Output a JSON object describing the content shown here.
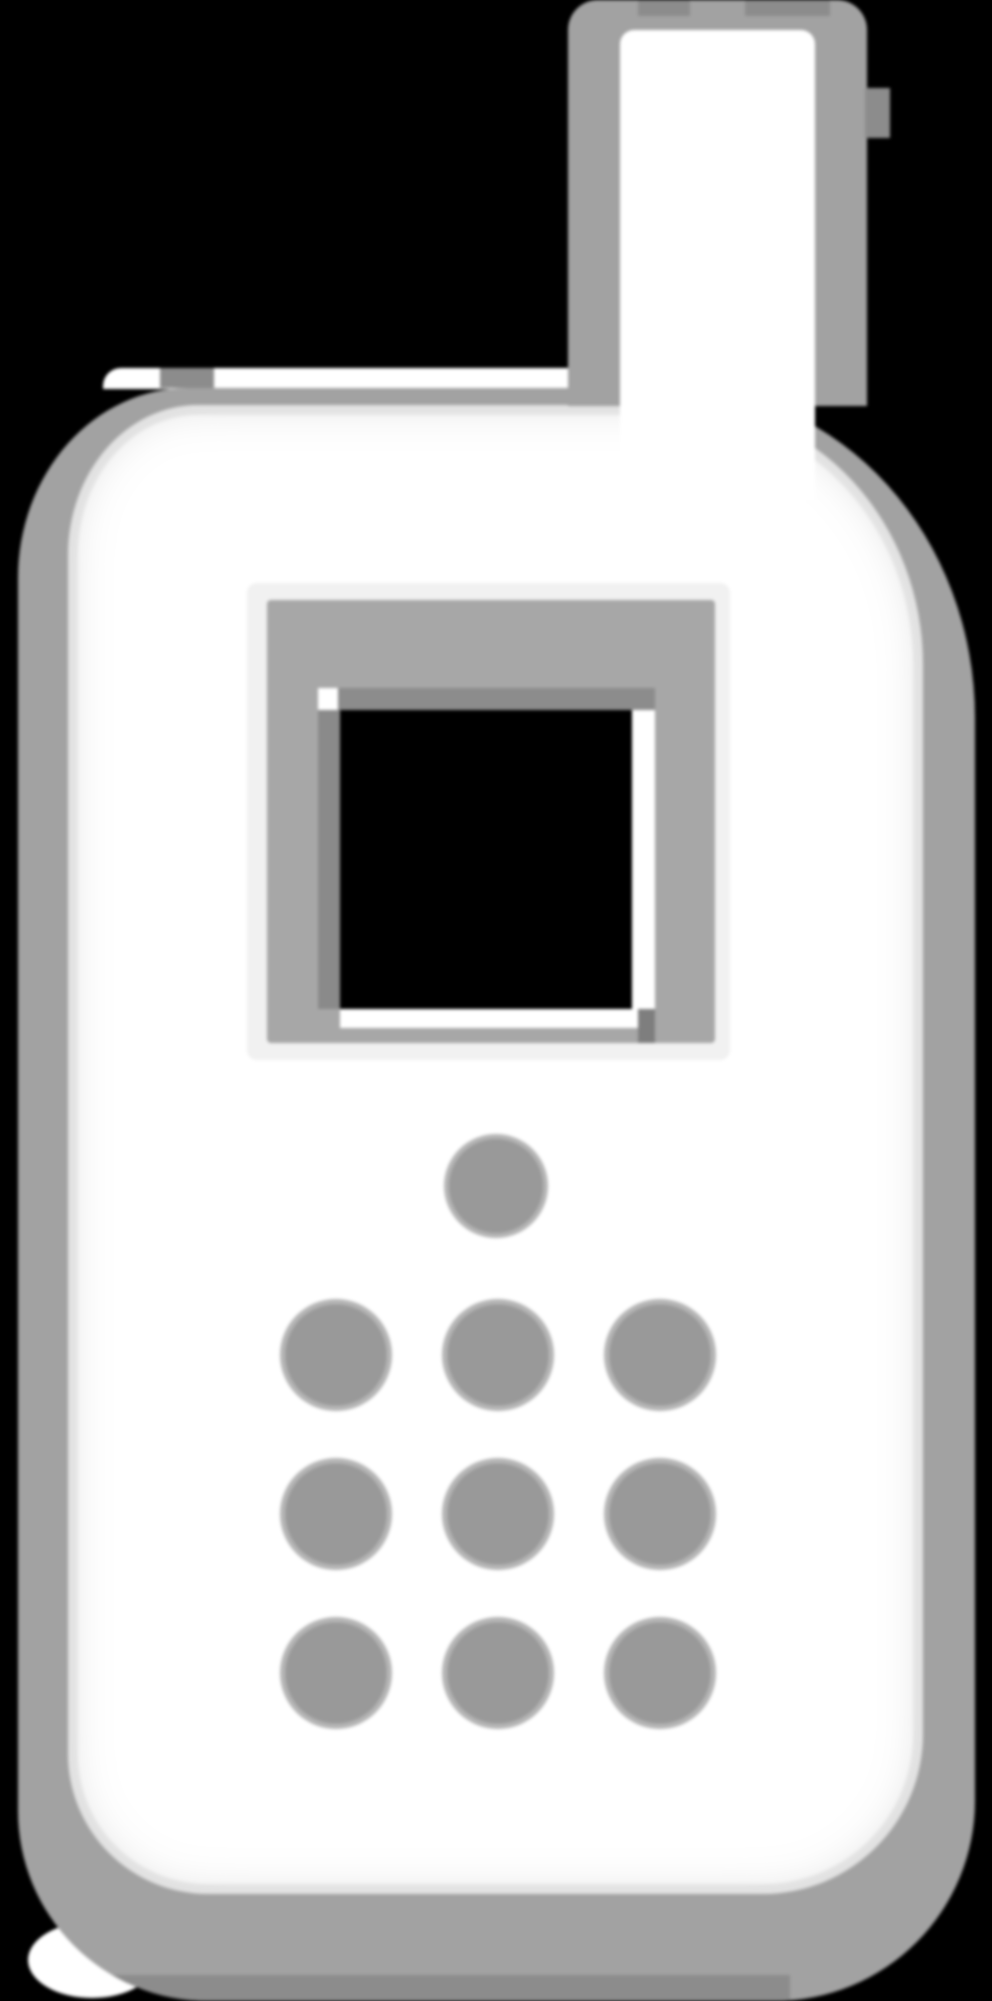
{
  "meta": {
    "description": "Large pixelated icon of a classic mobile phone (white silhouette on black): antenna at top, dark square display with gray bezel, and a keypad of ten gray dots (one top dot plus a 3x3 grid)."
  },
  "icon": {
    "name": "mobile-phone-icon",
    "background_color": "#000000",
    "phone_body_color": "#ffffff",
    "outline_color": "#a2a2a2",
    "outline_shadow_color": "#8c8c8c",
    "screen": {
      "display_color": "#000000",
      "frame_color": "#a7a7a7",
      "frame_halo_color": "#f1f1f1",
      "highlight_color": "#ffffff"
    },
    "keypad": {
      "dot_color": "#999999",
      "dot_halo_color": "#b5b5b5",
      "top_row_dots": 1,
      "grid_rows": 3,
      "grid_cols": 3,
      "total_dots": 10
    },
    "antenna": {
      "present": true,
      "position": "top-right"
    }
  }
}
